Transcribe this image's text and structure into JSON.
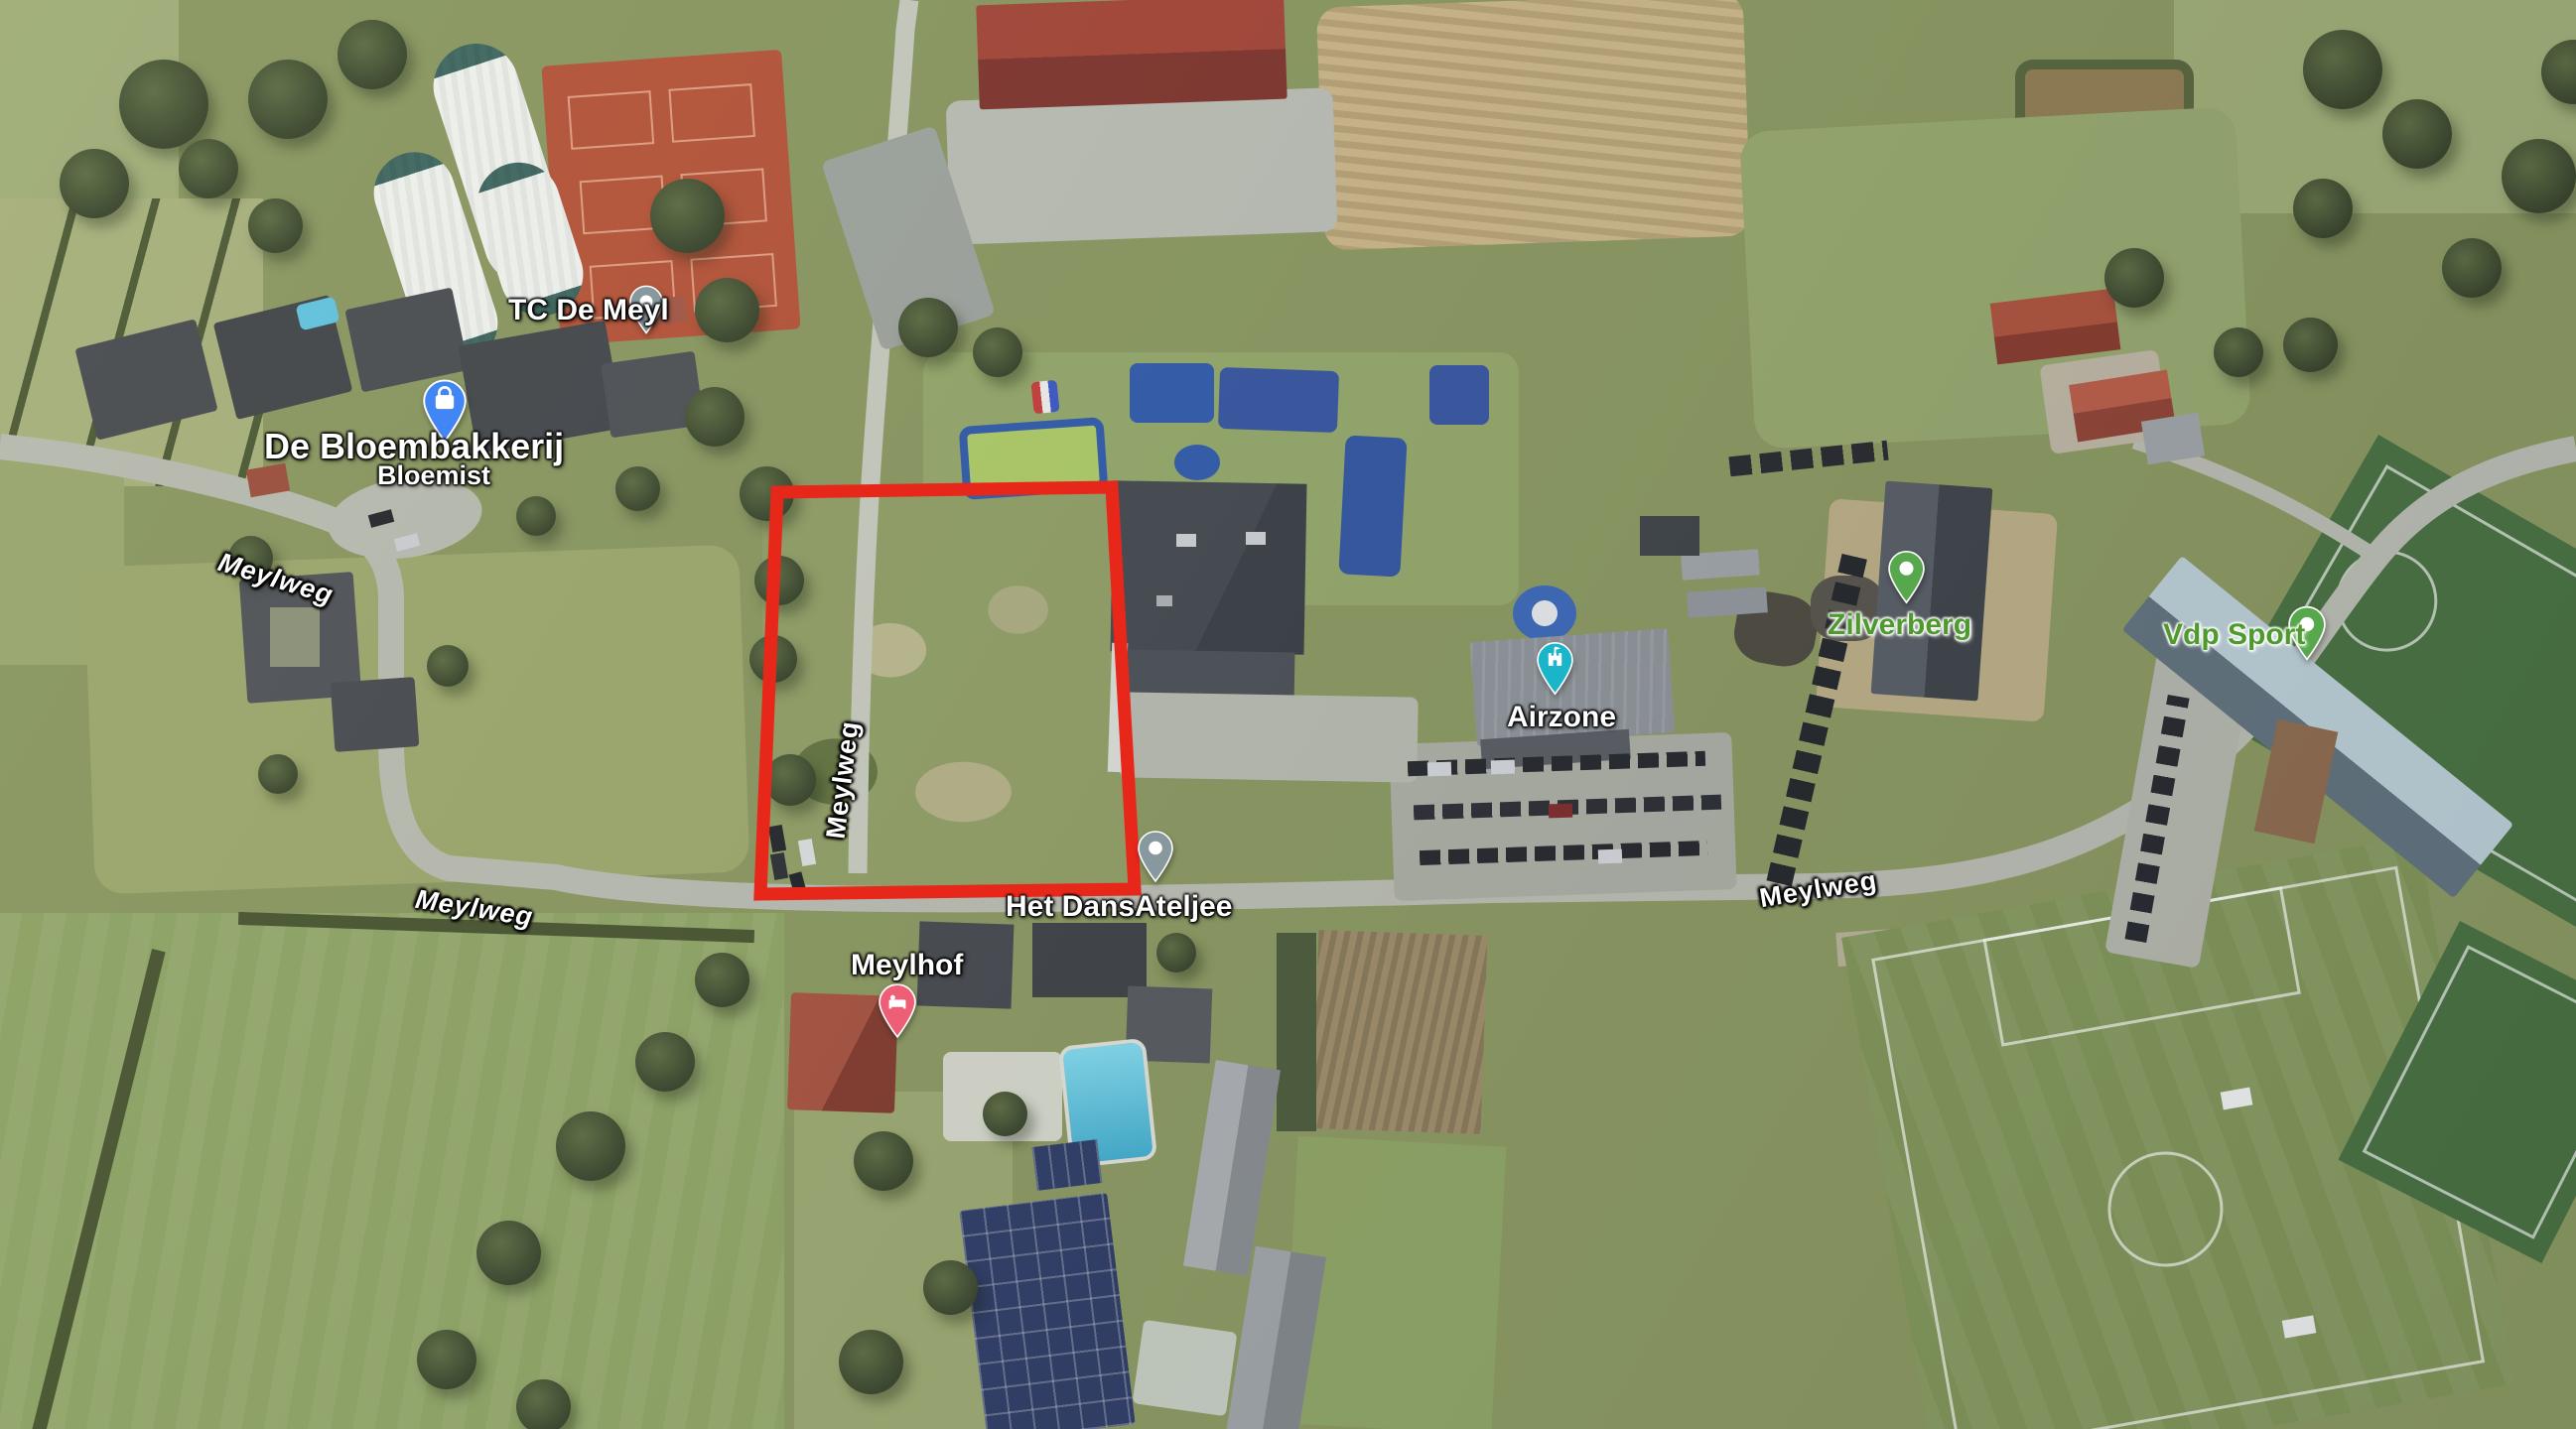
{
  "map": {
    "view": "oblique-satellite",
    "parcel": {
      "outline_color": "#e8271b"
    },
    "road_labels": [
      {
        "text": "Meylweg"
      },
      {
        "text": "Meylweg"
      },
      {
        "text": "Meylweg"
      },
      {
        "text": "Meylweg"
      }
    ],
    "places": [
      {
        "name": "TC De Meyl",
        "pin_icon": "generic-dot-pin",
        "pin_color": "#87989f",
        "label_color": "#ffffff"
      },
      {
        "name": "De Bloembakkerij",
        "subtitle": "Bloemist",
        "pin_icon": "shopping-bag-pin",
        "pin_color": "#4285f4",
        "label_color": "#ffffff"
      },
      {
        "name": "Het DansAteljee",
        "pin_icon": "generic-dot-pin",
        "pin_color": "#87989f",
        "label_color": "#ffffff"
      },
      {
        "name": "Meylhof",
        "pin_icon": "lodging-bed-pin",
        "pin_color": "#ef5e77",
        "label_color": "#ffffff"
      },
      {
        "name": "Airzone",
        "pin_icon": "attraction-castle-pin",
        "pin_color": "#1ab5c9",
        "label_color": "#ffffff"
      },
      {
        "name": "Zilverberg",
        "pin_icon": "generic-dot-pin",
        "pin_color": "#57a84c",
        "label_color": "#4f9a2e"
      },
      {
        "name": "Vdp Sport",
        "pin_icon": "generic-dot-pin",
        "pin_color": "#57a84c",
        "label_color": "#4f9a2e"
      }
    ]
  }
}
